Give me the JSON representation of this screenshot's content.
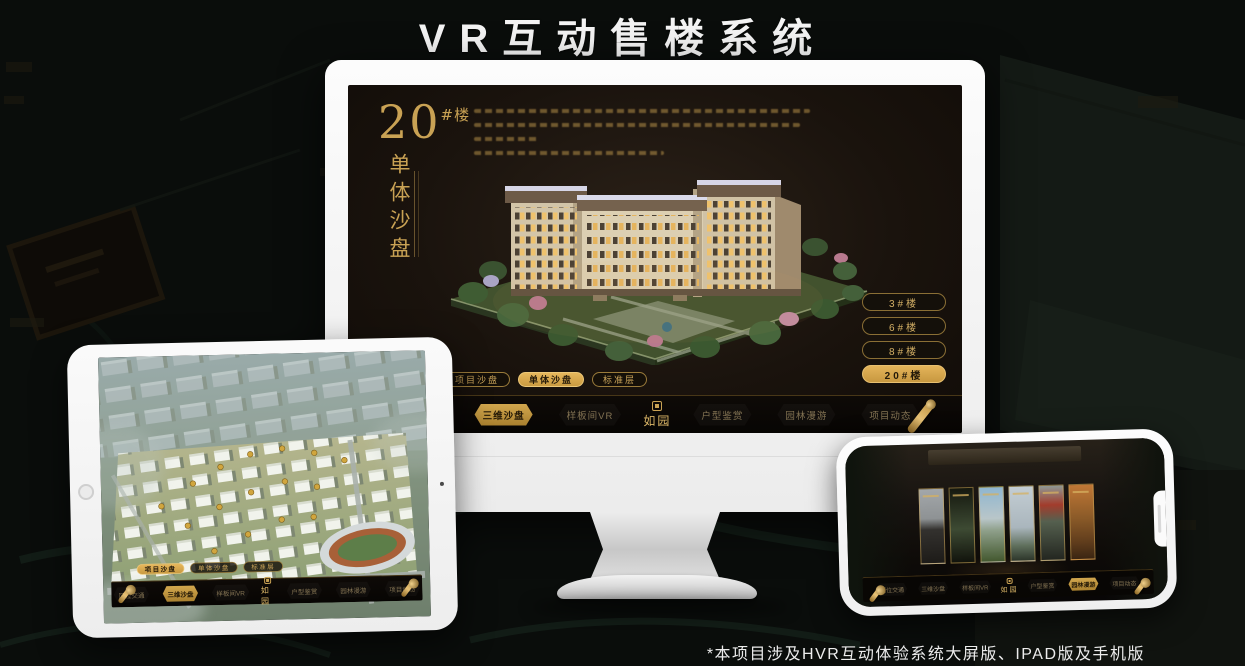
{
  "title": "VR互动售楼系统",
  "footnote": "*本项目涉及HVR互动体验系统大屏版、IPAD版及手机版",
  "brand": {
    "logo_text": "如园"
  },
  "app": {
    "nav_items": [
      {
        "label": "区位交通"
      },
      {
        "label": "三维沙盘"
      },
      {
        "label": "样板间VR"
      },
      {
        "label": "户型鉴赏"
      },
      {
        "label": "园林漫游"
      },
      {
        "label": "项目动态"
      }
    ],
    "active_nav_monitor": "三维沙盘",
    "active_nav_ipad": "三维沙盘",
    "active_nav_phone": "园林漫游"
  },
  "monitor": {
    "panel": {
      "big_number": "20",
      "unit": "#楼",
      "vertical_title": "单体沙盘"
    },
    "view_tabs": [
      {
        "label": "项目沙盘",
        "active": false
      },
      {
        "label": "单体沙盘",
        "active": true
      },
      {
        "label": "标准层",
        "active": false
      }
    ],
    "floor_buttons": [
      {
        "label": "3#楼",
        "active": false
      },
      {
        "label": "6#楼",
        "active": false
      },
      {
        "label": "8#楼",
        "active": false
      },
      {
        "label": "20#楼",
        "active": true
      }
    ]
  },
  "ipad": {
    "view_tabs": [
      {
        "label": "项目沙盘",
        "active": true
      },
      {
        "label": "单体沙盘",
        "active": false
      },
      {
        "label": "标准层",
        "active": false
      }
    ]
  },
  "colors": {
    "gold": "#c9a254",
    "gold_bright": "#d9a94f",
    "screen_bg": "#1a130e",
    "page_bg": "#0a0d0b"
  }
}
